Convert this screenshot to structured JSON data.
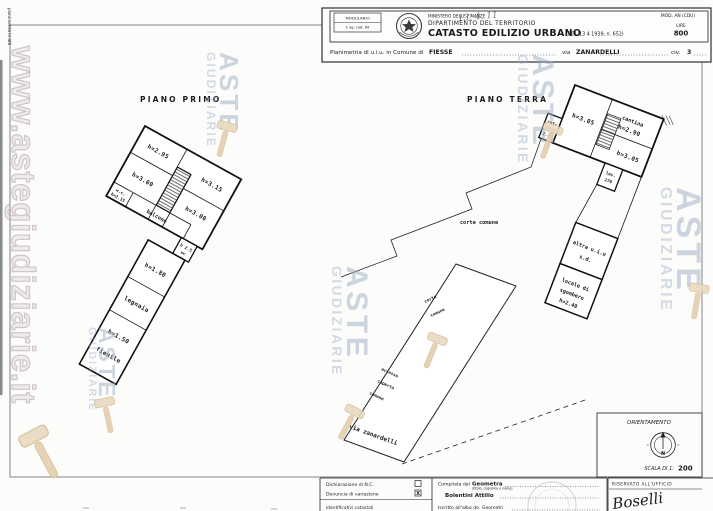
{
  "header": {
    "modulario1": "MODULARIO",
    "modulario2": "F. ag. cast. 64",
    "ministry1": "MINISTERO DELLE FINANZE",
    "ministry2": "DIPARTIMENTO DEL TERRITORIO",
    "title": "CATASTO EDILIZIO URBANO",
    "title_ref": "(RDL 13 4 1939, n. 652)",
    "mod_code": "MOD. AN (CDU)",
    "fee_label": "LIRE",
    "fee_value": "800",
    "pencil_note": "13. 4. 11",
    "planimetria_prefix": "Planimetria di u.i.u. in Comune di",
    "comune": "FIESSE",
    "via_label": "via",
    "via_name": "ZANARDELLI",
    "civ_label": "civ.",
    "civ_value": "3"
  },
  "margin_note": "planimetria in atti",
  "watermark": {
    "site": "www.astegiudiziarie.it",
    "word1": "ASTE",
    "word2": "GIUDIZIARIE"
  },
  "piano_primo": {
    "title": "PIANO PRIMO",
    "room1_h": "h=2.95",
    "room2_h": "h=3.00",
    "room3_h": "h=3.15",
    "room4_h": "h=3.00",
    "wc_label": "w.c.",
    "wc_h": "h=2.15",
    "balcone": "balcone",
    "wc2_h": "h 2.5",
    "wc2_label": "wc",
    "legnaia_h": "h=1.80",
    "legnaia": "legnaia",
    "fienile_h": "h=1.50",
    "fienile": "fienile"
  },
  "piano_terra": {
    "title": "PIANO TERRA",
    "room1_h": "h=3.05",
    "cantina": "cantina",
    "cantina_h": "h=2.90",
    "room2_h": "h=3.05",
    "cottura1": "cot-",
    "cottura2": "tura",
    "cottura_h": "2.75",
    "lav": "lav.",
    "lav_h": "270",
    "corte_comune": "corte comune",
    "altra1": "altra u.i.u",
    "altra2": "s.d.",
    "locale1": "locale di",
    "locale2": "sgombero",
    "locale_h": "h=2.40",
    "corte2a": "corte",
    "corte2b": "comune",
    "accesso1": "accesso",
    "accesso2": "coperto",
    "accesso3": "comune",
    "via": "via zanardelli"
  },
  "orientation": {
    "title": "ORIENTAMENTO",
    "north": "N",
    "scale_label": "SCALA DI 1:",
    "scale_value": "200"
  },
  "footer": {
    "decl1": "Dichiarazione di N.C.",
    "decl2": "Denuncia di variazione",
    "decl2_mark": "X",
    "decl3": "Identificativi catastali",
    "compiled_label": "Compilata dal",
    "compiled_role": "Geometra",
    "compiled_sub": "(titolo, cognome e nome)",
    "compiled_name": "Bolentini Attilio",
    "albo_line": "Iscritto all'albo de. Geometri",
    "reserved": "RISERVATO ALL'UFFICIO",
    "signature": "Boselli"
  }
}
